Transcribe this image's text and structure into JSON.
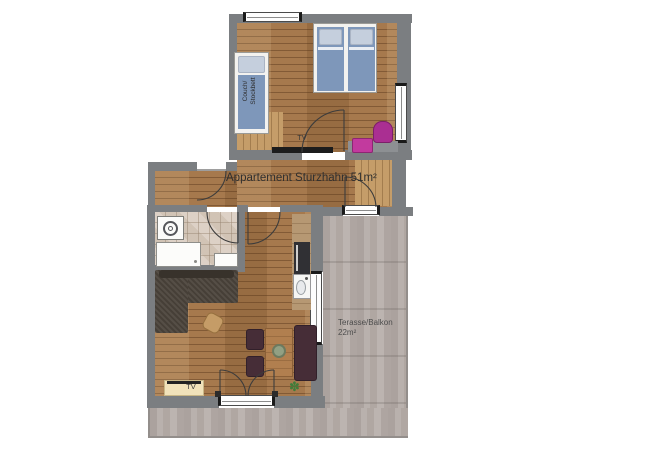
{
  "title": "Appartement Sturzhahn floor plan",
  "rooms": {
    "apartment_label": "Appartement Sturzhahn 51m²",
    "terrace_label_line1": "Terasse/Balkon",
    "terrace_label_line2": "22m²"
  },
  "furniture_labels": {
    "bedroom_tv": "TV",
    "living_tv": "TV",
    "couch_bed_line1": "Couch/",
    "couch_bed_line2": "Stockbett"
  },
  "icons": {
    "plant_glyph": "✽"
  },
  "colors": {
    "wall": "#7b7e81",
    "wood_floor": "#a6794d",
    "wood_light": "#c59d69",
    "bath_tile": "#d8cbbe",
    "terrace_tile": "#b3aba7",
    "bed_blue": "#7e97ba",
    "pillow_blue": "#c5cfdd",
    "accent_pink": "#c23a9e",
    "accent_pink_dark": "#aa2f92",
    "sofa_brown": "#4c443c",
    "chair_maroon": "#462d37",
    "table_wood": "#b17f4f",
    "shelf_cream": "#f1e2ba"
  }
}
